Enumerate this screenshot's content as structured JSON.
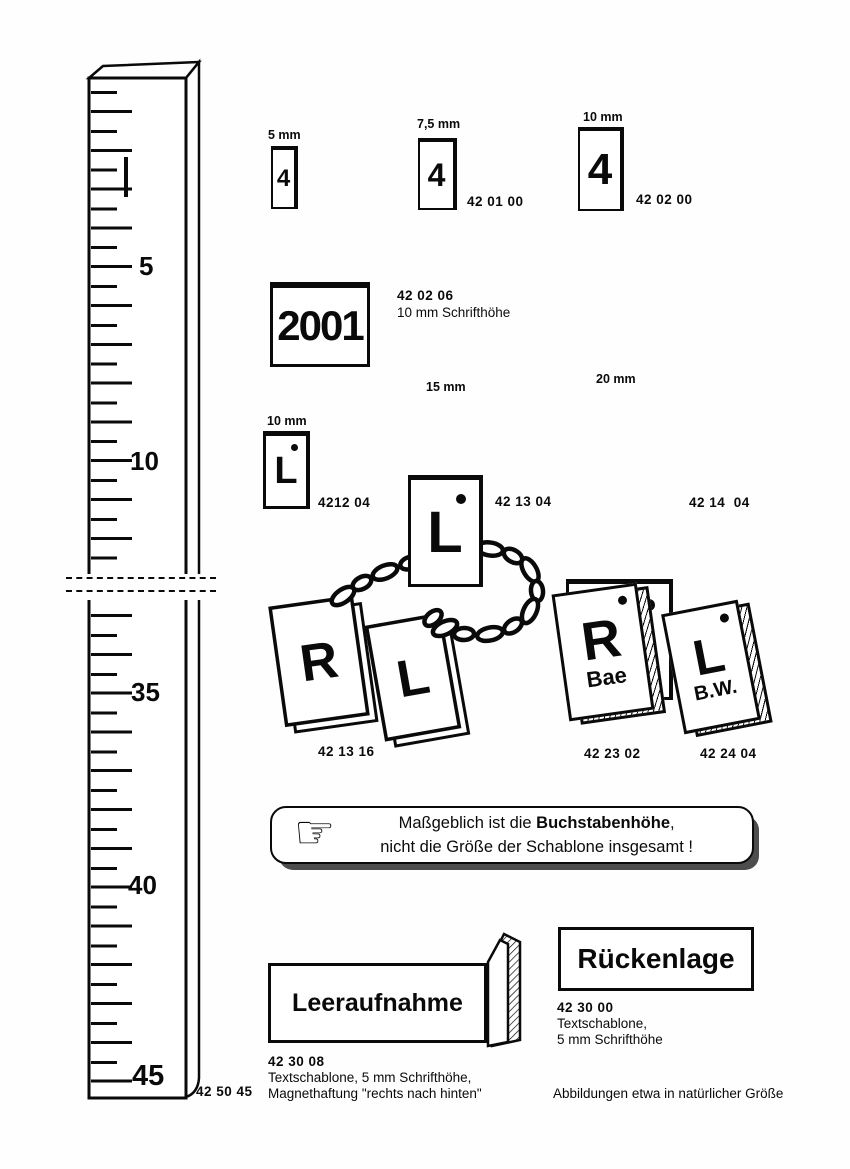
{
  "ruler": {
    "marks": [
      "5",
      "10",
      "35",
      "40",
      "45"
    ],
    "code": "42 50 45"
  },
  "number_templates": {
    "items": [
      {
        "size_label": "5 mm",
        "glyph": "4",
        "code": ""
      },
      {
        "size_label": "7,5 mm",
        "glyph": "4",
        "code": "42 01 00"
      },
      {
        "size_label": "10 mm",
        "glyph": "4",
        "code": "42 02 00"
      }
    ]
  },
  "year_template": {
    "glyph": "2001",
    "code": "42 02 06",
    "desc": "10 mm Schrifthöhe"
  },
  "letter_templates": {
    "items": [
      {
        "size_label": "10 mm",
        "glyph": "L",
        "code": "4212 04"
      },
      {
        "size_label": "15 mm",
        "glyph": "L",
        "code": "42 13 04"
      },
      {
        "size_label": "20 mm",
        "glyph": "L",
        "code": "42 14  04"
      }
    ]
  },
  "chain_set": {
    "left_glyph": "R",
    "right_glyph": "L",
    "code": "42 13 16"
  },
  "initial_tiles": {
    "items": [
      {
        "glyph": "R",
        "sub": "Bae",
        "code": "42 23 02"
      },
      {
        "glyph": "L",
        "sub": "B.W.",
        "code": "42 24 04"
      }
    ]
  },
  "notice": {
    "icon_glyph": "☞",
    "line1_pre": "Maßgeblich ist die ",
    "line1_bold": "Buchstabenhöhe",
    "line1_post": ",",
    "line2": "nicht die Größe der Schablone insgesamt !"
  },
  "text_templates": {
    "leeraufnahme": {
      "label": "Leeraufnahme",
      "code": "42 30 08",
      "desc1": "Textschablone, 5 mm Schrifthöhe,",
      "desc2": "Magnethaftung \"rechts nach hinten\""
    },
    "rueckenlage": {
      "label": "Rückenlage",
      "code": "42 30 00",
      "desc1": "Textschablone,",
      "desc2": "5 mm Schrifthöhe"
    }
  },
  "footer": {
    "note": "Abbildungen etwa in natürlicher Größe"
  }
}
